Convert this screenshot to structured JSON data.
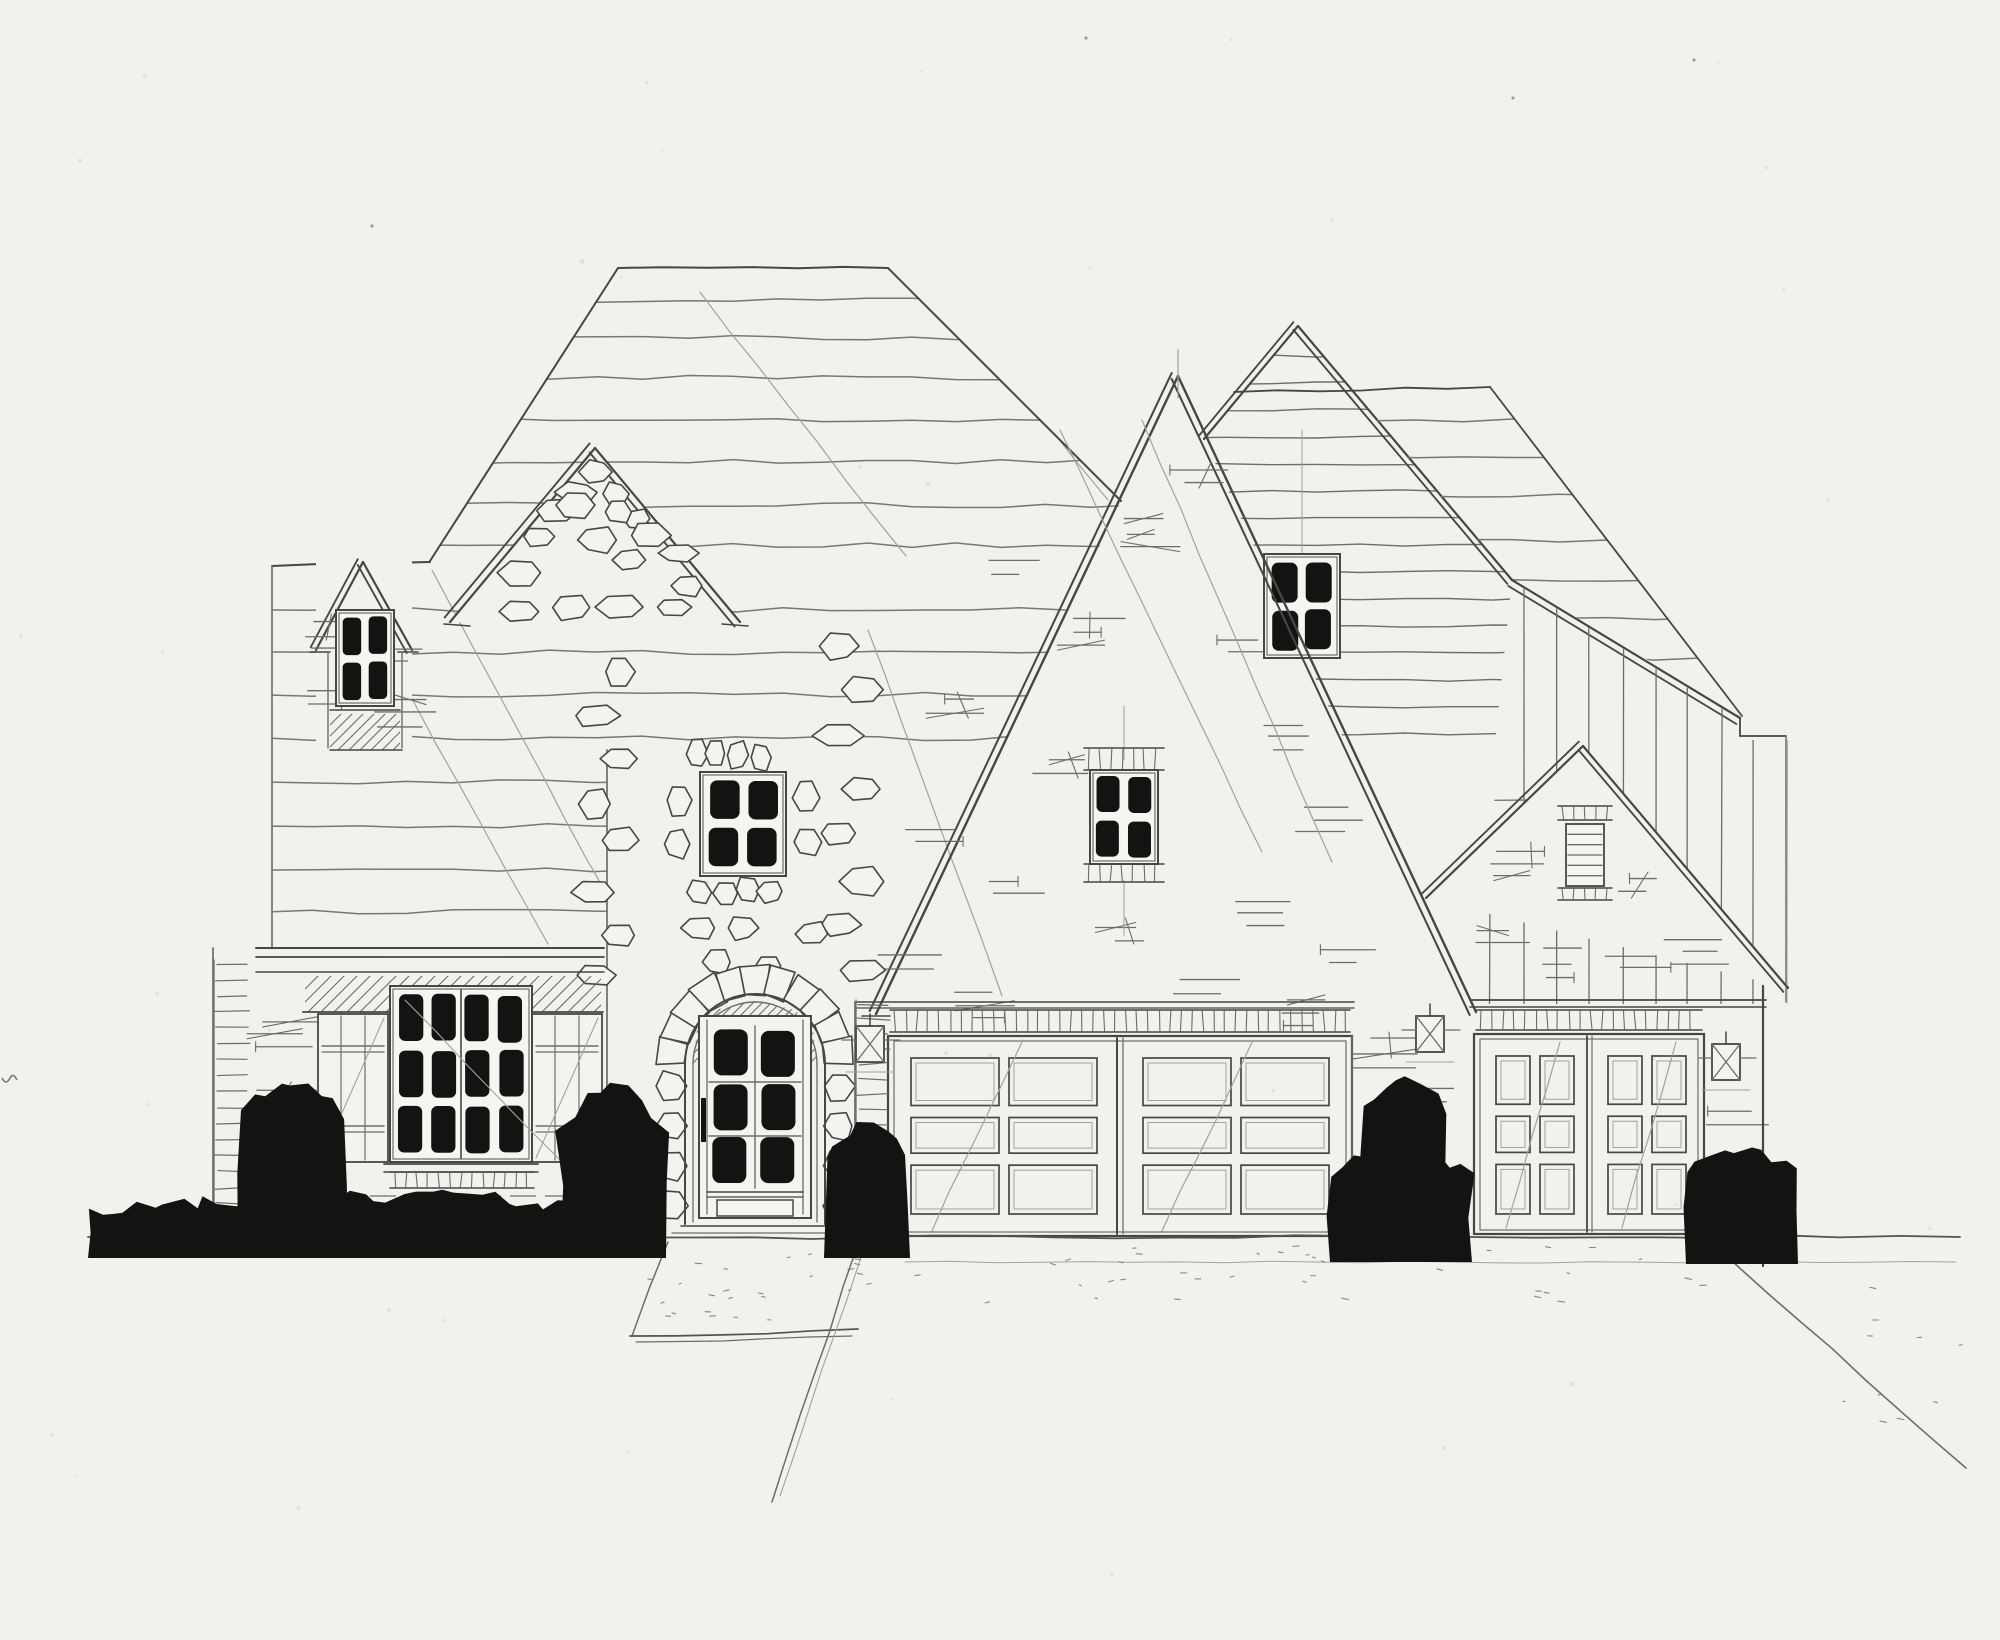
{
  "document": {
    "kind": "architectural front elevation sketch",
    "medium": "pencil and ink on paper"
  },
  "palette": {
    "paper": "#f2f1ed",
    "pencil_dark": "#474645",
    "pencil_mid": "#6e6c68",
    "pencil_shingle": "#7a7773",
    "pencil_light": "#a3a19c",
    "ink": "#141312"
  },
  "elements": {
    "left_dormer_window": {
      "panes": "2x2"
    },
    "left_window": {
      "panes": "4x3",
      "shutters": 2
    },
    "stone_stair_window": {
      "panes": "2x2"
    },
    "entry_door": {
      "panes": "2x3",
      "bottom_panel": 1,
      "arched_stone_surround": true
    },
    "center_gable_window": {
      "panes": "2x2"
    },
    "siding_gable_window": {
      "panes": "2x2"
    },
    "right_gable_vent": {
      "louvers": 5
    },
    "double_garage": {
      "doors": 2,
      "panels_per_door": "2x3"
    },
    "single_garage": {
      "doors": 1,
      "leaves": 2,
      "panels_per_leaf": "2x3"
    },
    "wall_lanterns": 3,
    "bush_clusters": 5
  }
}
